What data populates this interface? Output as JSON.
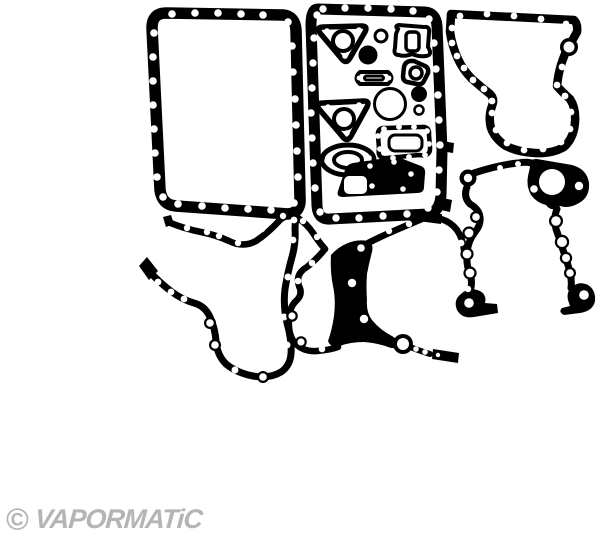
{
  "canvas": {
    "background_color": "#ffffff",
    "line_color": "#000000"
  },
  "watermark": {
    "copyright_symbol": "©",
    "brand": "VAPORMATiC",
    "color": "#b5b5b5"
  },
  "illustration": {
    "description_parts": [
      "oil-pan-gasket",
      "sump-frame-gasket-with-small-gaskets",
      "timing-case-gasket",
      "front-cover-gasket",
      "crankcase-plate-gaskets"
    ]
  }
}
